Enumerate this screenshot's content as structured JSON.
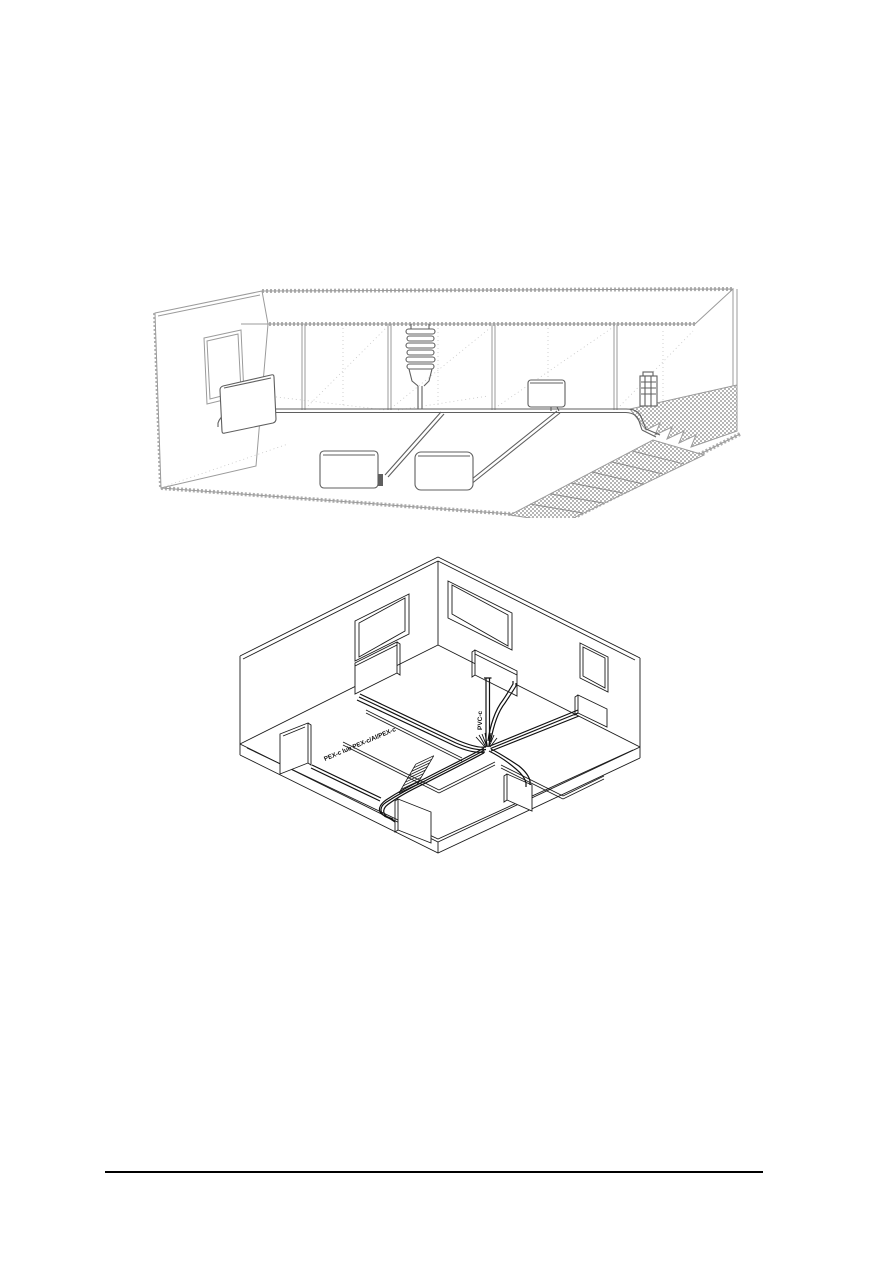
{
  "page": {
    "background": "#ffffff",
    "footer_rule_color": "#000000"
  },
  "figure_top": {
    "name": "cutaway-section-heating-distribution",
    "stroke_light": "#9b9b9b",
    "stroke_dark": "#5f5f5f",
    "stairs_fill": "#b6b6b6"
  },
  "figure_bottom": {
    "name": "isometric-floorplan-heating-pipework",
    "stroke": "#1b1b1b",
    "pipe_color": "#111111",
    "labels": {
      "riser_pipe": "PVC-c",
      "distribution_pipes": "PEX-c lub PEX-c/Al/PEX-c"
    }
  }
}
